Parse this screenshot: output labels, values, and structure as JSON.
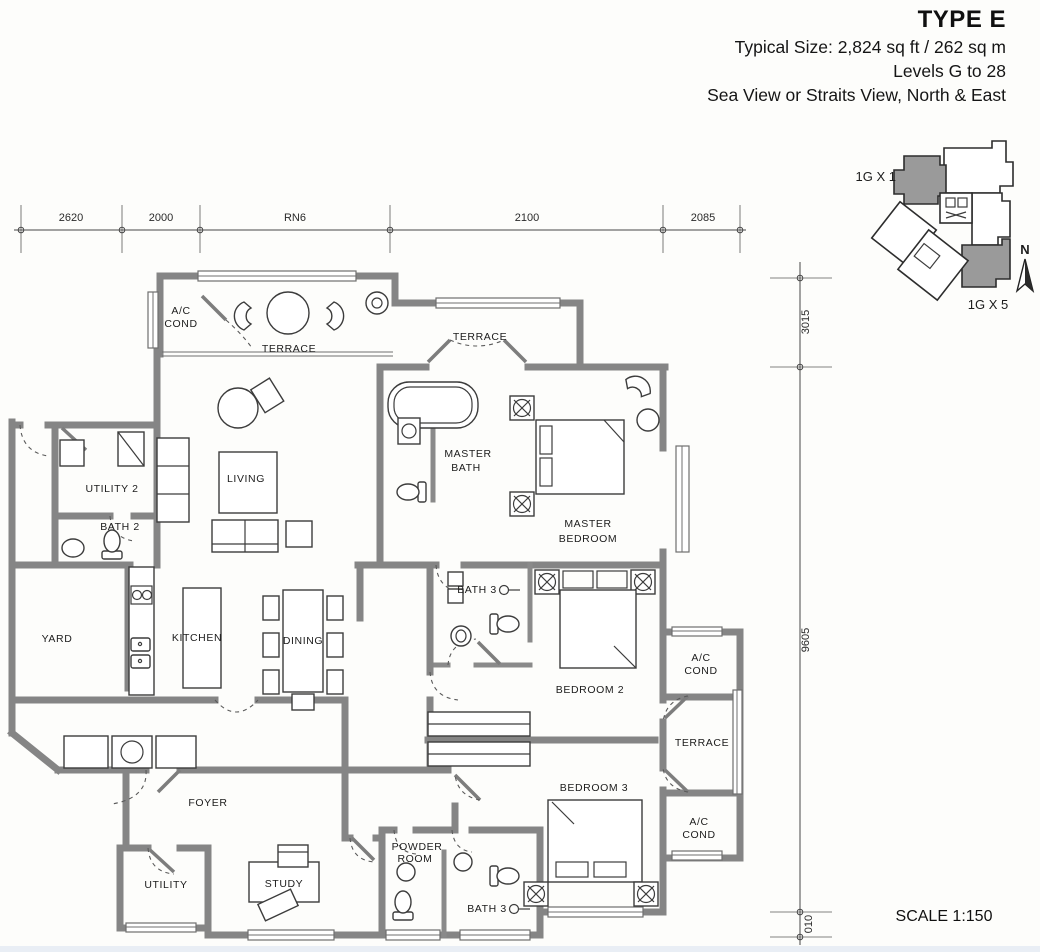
{
  "header": {
    "title": "TYPE E",
    "size": "Typical Size: 2,824 sq ft / 262 sq m",
    "levels": "Levels G to 28",
    "view": "Sea View or Straits View, North & East"
  },
  "scale": "SCALE 1:150",
  "key_plan": {
    "label_top": "1G X 1",
    "label_bottom": "1G X 5",
    "north": "N"
  },
  "dimensions": {
    "top": [
      "2620",
      "2000",
      "RN6",
      "2100",
      "2085"
    ],
    "right": [
      "3015",
      "9605",
      "010"
    ]
  },
  "labels": {
    "ac1a": "A/C",
    "ac1b": "COND",
    "terrace_top": "TERRACE",
    "terrace_mid": "TERRACE",
    "living": "LIVING",
    "master_bath_a": "MASTER",
    "master_bath_b": "BATH",
    "master_bedroom_a": "MASTER",
    "master_bedroom_b": "BEDROOM",
    "utility2": "UTILITY 2",
    "bath2": "BATH 2",
    "yard": "YARD",
    "kitchen": "KITCHEN",
    "dining": "DINING",
    "bath3_mid": "BATH 3",
    "bedroom2": "BEDROOM 2",
    "bedroom3": "BEDROOM 3",
    "ac2a": "A/C",
    "ac2b": "COND",
    "terrace_right": "TERRACE",
    "ac3a": "A/C",
    "ac3b": "COND",
    "foyer": "FOYER",
    "utility": "UTILITY",
    "study": "STUDY",
    "powder_a": "POWDER",
    "powder_b": "ROOM",
    "bath3_bottom": "BATH 3"
  },
  "colors": {
    "wall": "#858585",
    "keyplan_highlight": "#9a9a9a",
    "text": "#1c1c1c"
  }
}
